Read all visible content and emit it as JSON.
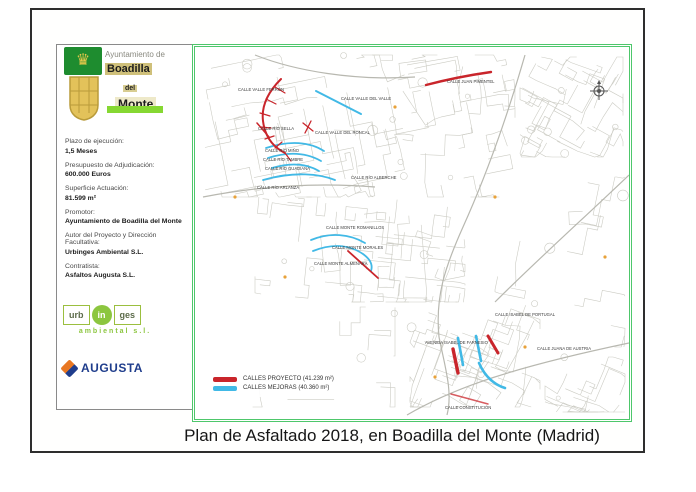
{
  "page": {
    "title": "Plan de Asfaltado 2018, en Boadilla del Monte (Madrid)"
  },
  "logo": {
    "line1": "Ayuntamiento de",
    "line2": "Boadilla",
    "line3": "del",
    "line4": "Monte"
  },
  "info_panel": {
    "fields": [
      {
        "label": "Plazo de ejecución:",
        "value": "1,5 Meses"
      },
      {
        "label": "Presupuesto de Adjudicación:",
        "value": "600.000 Euros"
      },
      {
        "label": "Superficie Actuación:",
        "value": "81.599 m²"
      },
      {
        "label": "Promotor:",
        "value": "Ayuntamiento de Boadilla del Monte"
      },
      {
        "label": "Autor del Proyecto y Dirección Facultativa:",
        "value": "Urbinges Ambiental S.L."
      },
      {
        "label": "Contratista:",
        "value": "Asfaltos Augusta S.L."
      }
    ]
  },
  "logos": {
    "urbinges": {
      "part1": "urb",
      "part2": "in",
      "part3": "ges",
      "subtitle": "ambiental s.l."
    },
    "augusta": {
      "name": "AUGUSTA"
    }
  },
  "map": {
    "colors": {
      "border": "#4ec76b",
      "proyecto_red": "#c9252b",
      "mejoras_blue": "#41b9e6",
      "network_gray": "#ccccc4"
    },
    "legend": {
      "items": [
        {
          "color": "#c9252b",
          "label": "CALLES PROYECTO (41.239 m²)"
        },
        {
          "color": "#41b9e6",
          "label": "CALLES MEJORAS (40.360 m²)"
        }
      ]
    },
    "labels": [
      "CALLE VALLE FERRÓN",
      "CALLE VALLE DEL VALLE",
      "CALLE RÍO SELLA",
      "CALLE VALLE DEL RONCAL",
      "CALLE RÍO MIÑO",
      "CALLE RÍO TAMBRE",
      "CALLE RÍO GUADIANA",
      "CALLE RÍO ARLANZA",
      "CALLE RÍO ALBERCHE",
      "CALLE JUAN PIMENTEL",
      "CALLE MONTE ROMANILLOS",
      "CALLE MONTE MORALES",
      "CALLE MONTE ALMENARA",
      "CALLE ISABEL DE PORTUGAL",
      "AVENIDA ISABEL DE FARNESIO",
      "CALLE JUANA DE AUSTRIA",
      "CALLE CONSTITUCIÓN"
    ]
  }
}
